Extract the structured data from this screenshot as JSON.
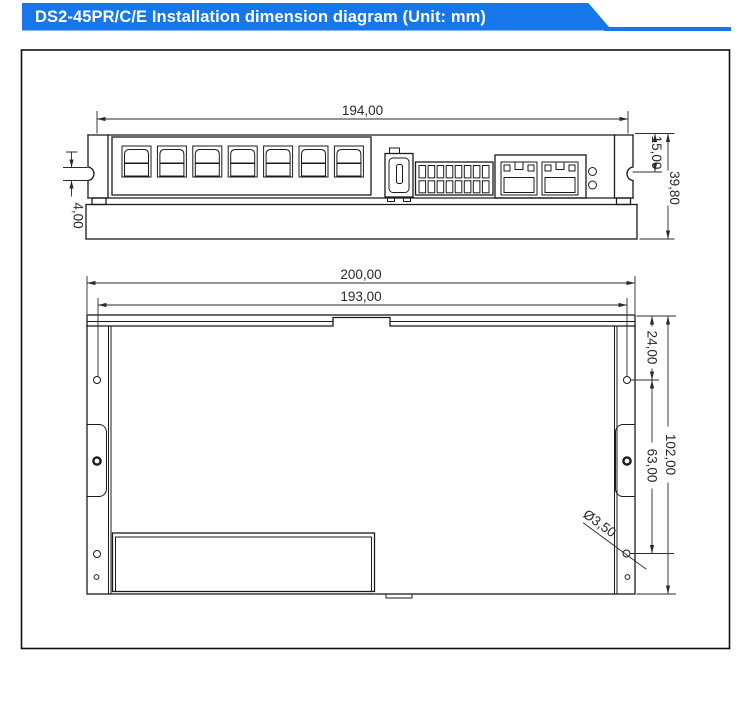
{
  "title": {
    "text": "DS2-45PR/C/E Installation dimension diagram (Unit: mm)"
  },
  "colors": {
    "banner_blue": "#1577e9",
    "drawing_line": "#1b1b1b",
    "dimension_text": "#2a2a2a",
    "background": "#ffffff"
  },
  "top_view": {
    "dimensions": {
      "body_width": "194,00",
      "notch_height": "4,00",
      "notch_offset": "15,00",
      "total_height": "39,80"
    }
  },
  "bottom_view": {
    "dimensions": {
      "overall_width": "200,00",
      "hole_spacing": "193,00",
      "hole_top_offset": "24,00",
      "hole_mid_spacing": "63,00",
      "overall_height": "102,00",
      "hole_diameter": "Ø3,50"
    }
  }
}
